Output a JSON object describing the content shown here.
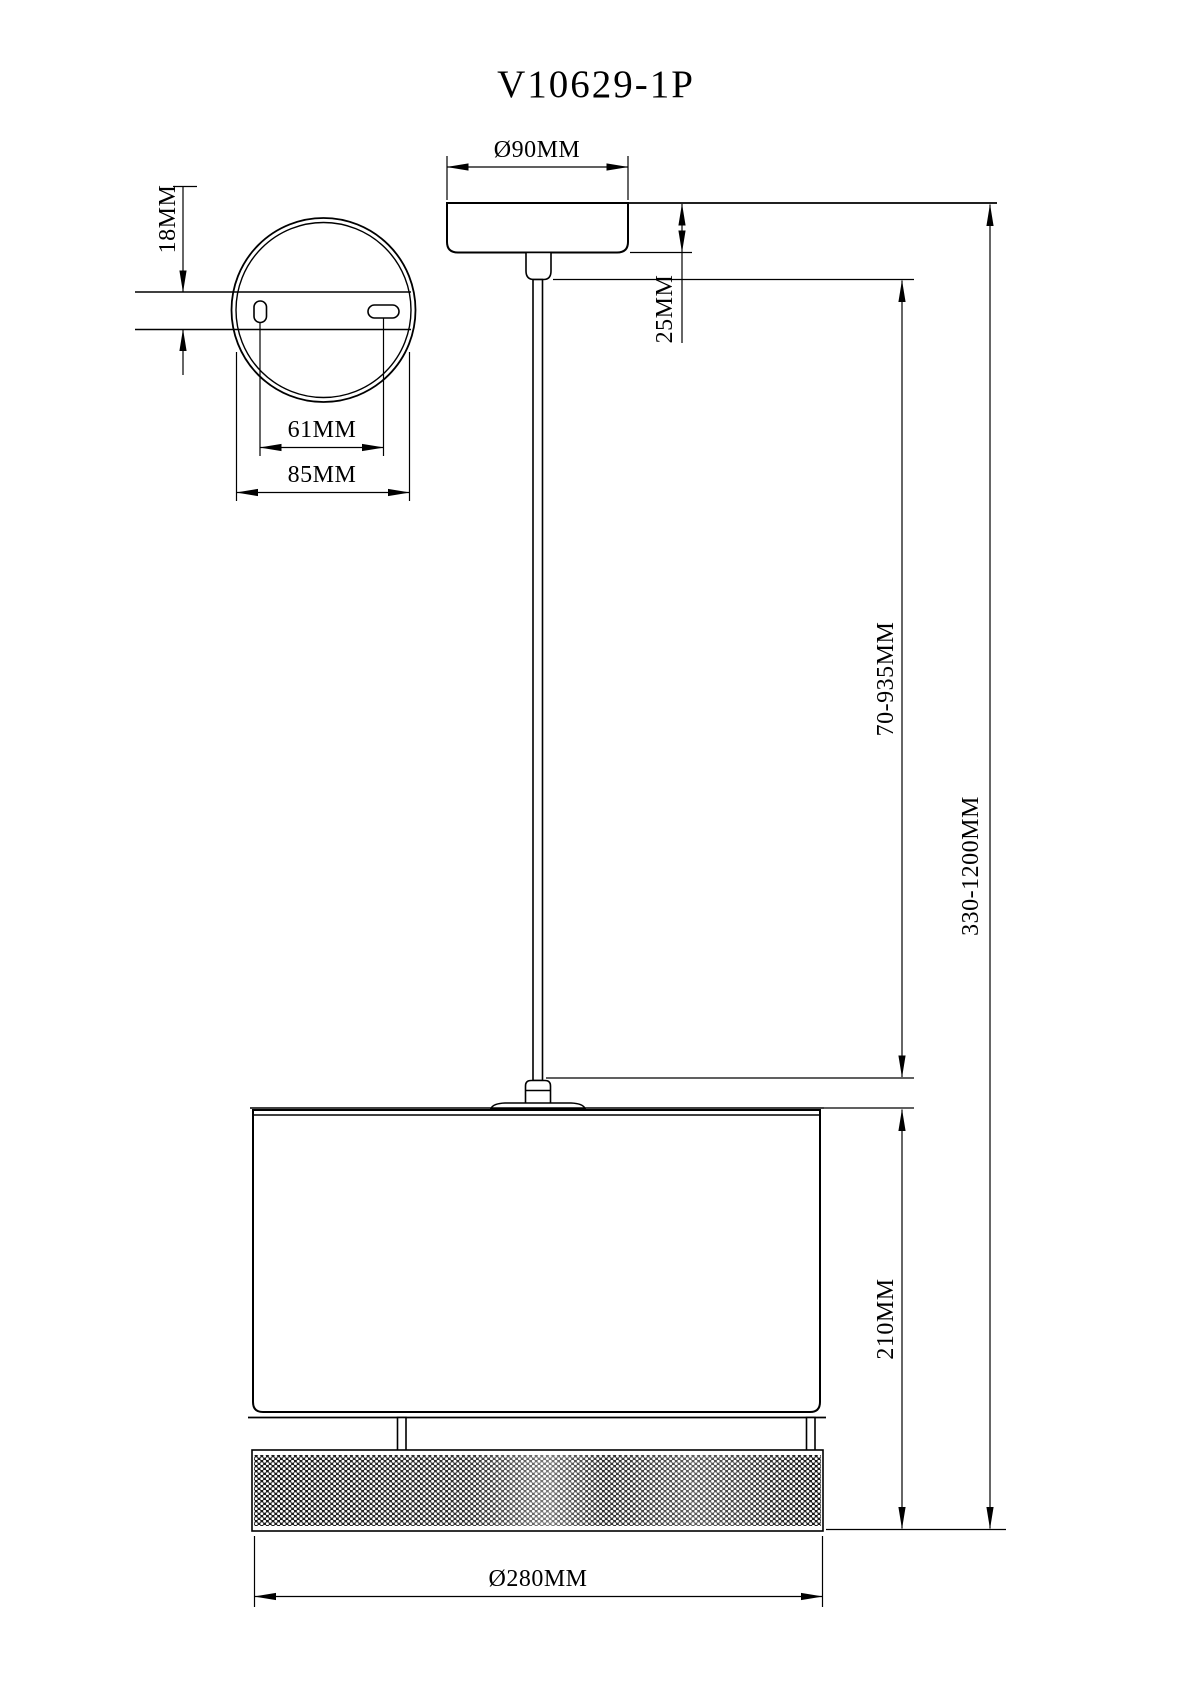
{
  "drawing": {
    "title": "V10629-1P",
    "colors": {
      "line": "#000000",
      "background": "#ffffff"
    },
    "dimensions": {
      "canopy_diameter": "Ø90MM",
      "canopy_height": "25MM",
      "plate_thickness": "18MM",
      "hole_spacing": "61MM",
      "plate_width": "85MM",
      "rod_drop_range": "70-935MM",
      "overall_drop_range": "330-1200MM",
      "shade_height": "210MM",
      "shade_diameter": "Ø280MM"
    }
  }
}
